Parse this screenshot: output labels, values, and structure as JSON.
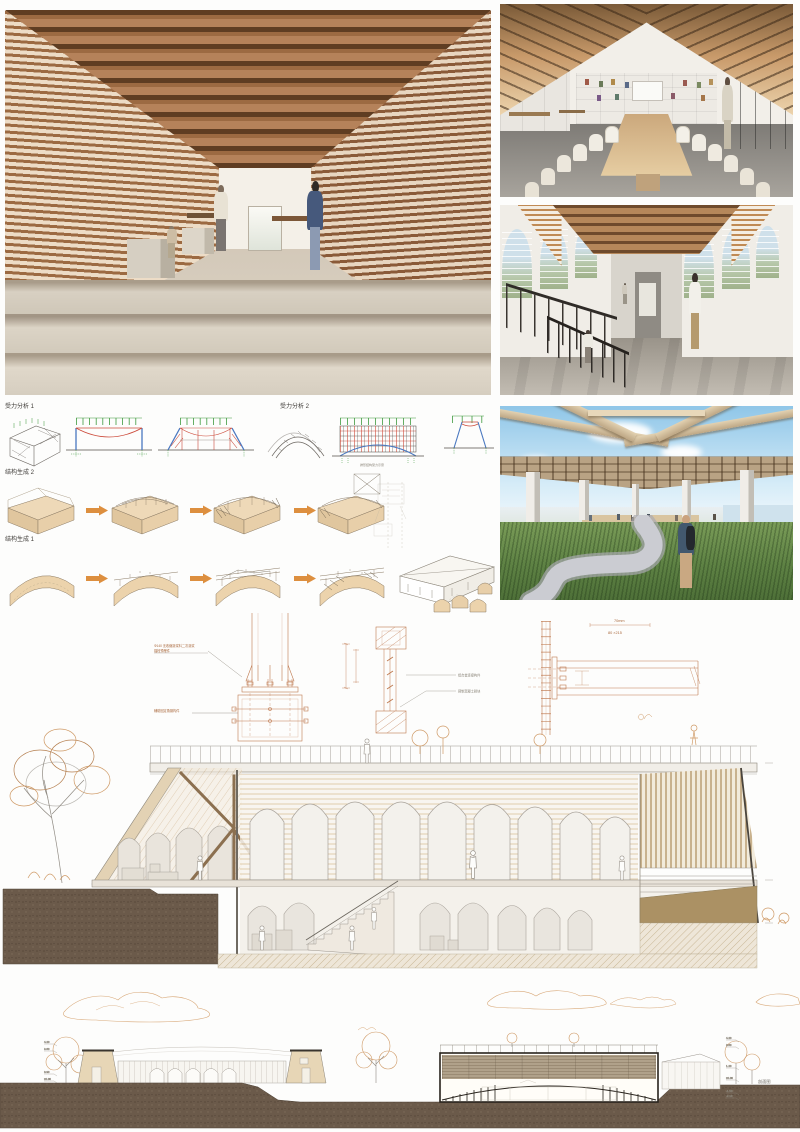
{
  "palette": {
    "wood_dark": "#6e4a2c",
    "wood_mid": "#a9744a",
    "wood_light": "#ecd3ac",
    "concrete": "#d8d1c4",
    "drawing_orange": "#bf7a50",
    "drawing_grey": "#9a948c",
    "soil_brown": "#6b5a4a",
    "sky_blue": "#8fc6e8",
    "grass_green": "#5e8244",
    "accent_arrow": "#dd8f3f"
  },
  "structure_diagrams": {
    "force_analysis_1": "受力分析 1",
    "force_analysis_2": "受力分析 2",
    "generation_2": "结构生成 2",
    "generation_1": "结构生成 1",
    "arch_caption": "拱形结构受力示意"
  },
  "construction_details": {
    "base_callout_line1": "Φ140 无收缩灌浆料二次灌浆",
    "base_callout_line2": "锚栓预埋件",
    "base_callout_lower": "辅助固定角钢构件",
    "mullion_callout_upper": "铝合金连接构件",
    "mullion_callout_lower": "预制混凝土砌块",
    "beam_dim_offset": "70mm",
    "beam_dim_size": "80 ×215"
  },
  "elevation_drawing": {
    "label": "剖面图",
    "levels_left": [
      "4.20",
      "3.60",
      "0.90",
      "±0.00",
      "-1.50",
      "-2.10"
    ],
    "levels_right": [
      "4.20",
      "3.60",
      "1.20",
      "±0.00",
      "-1.50",
      "-2.10"
    ]
  }
}
